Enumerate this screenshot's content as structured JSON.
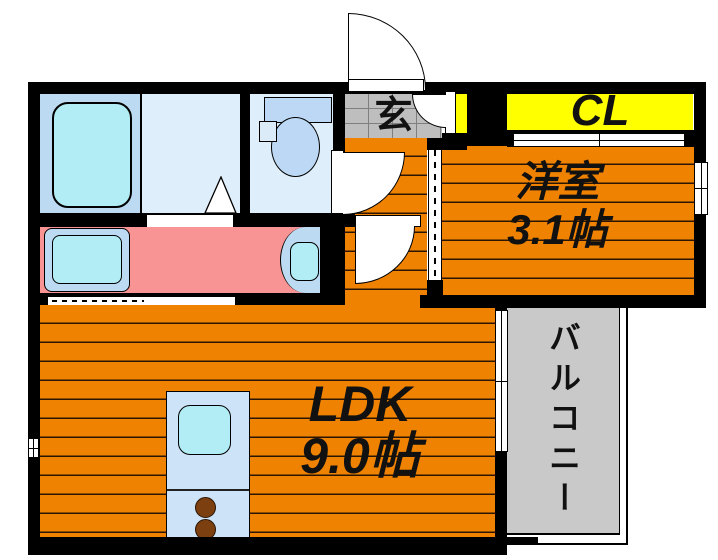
{
  "labels": {
    "entrance": "玄",
    "closet": "CL",
    "western_room": {
      "name": "洋室",
      "size": "3.1帖"
    },
    "ldk": {
      "name": "LDK",
      "size": "9.0帖"
    },
    "balcony": "バルコニー"
  },
  "colors": {
    "floor": "#EF8200",
    "plank": "#2a1505",
    "wall": "#000000",
    "closet": "#FFFF00",
    "washroom": "#F89494",
    "balcony": "#C9C9C9",
    "tile": "#BEBEBE",
    "tilegrid": "#7F7F7F",
    "roomblue": "#DFEEFB",
    "fixtureblue": "#BDDAF3",
    "cyan": "#B2ECF4",
    "toiletblue": "#BCD8F4",
    "kitchen": "#CDE3F7",
    "burner": "#7B3F10",
    "ink": "#111111"
  }
}
